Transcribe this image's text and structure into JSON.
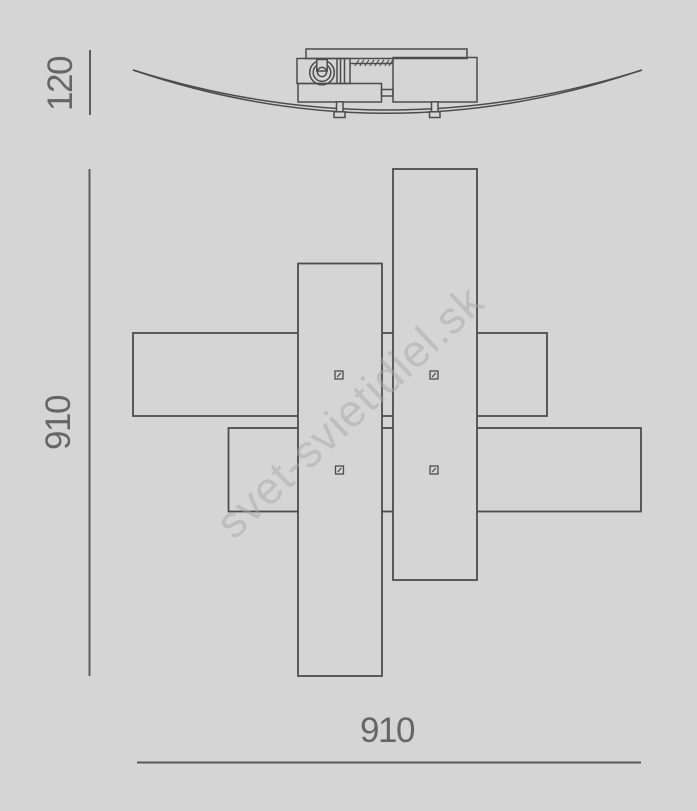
{
  "page": {
    "background": "#d5d5d5",
    "line_color": "#4c4c4c",
    "text_color": "#666666"
  },
  "drawing": {
    "subject": "ceiling-lamp technical dimension drawing",
    "views": [
      "front view: shallow curved glass diffuser with ceiling canopy, gear housing and two glass clips",
      "plan view: four overlapping rectangular glass panels with four fixing screws"
    ]
  },
  "dims": {
    "side_height": {
      "value": "120",
      "orientation": "vertical",
      "position": "top-left"
    },
    "plan_depth": {
      "value": "910",
      "orientation": "vertical",
      "position": "left"
    },
    "plan_width": {
      "value": "910",
      "orientation": "horizontal",
      "position": "bottom"
    }
  },
  "watermark": {
    "text": "svet-svietidiel.sk",
    "color": "#bebebe",
    "angle_deg": -43
  }
}
